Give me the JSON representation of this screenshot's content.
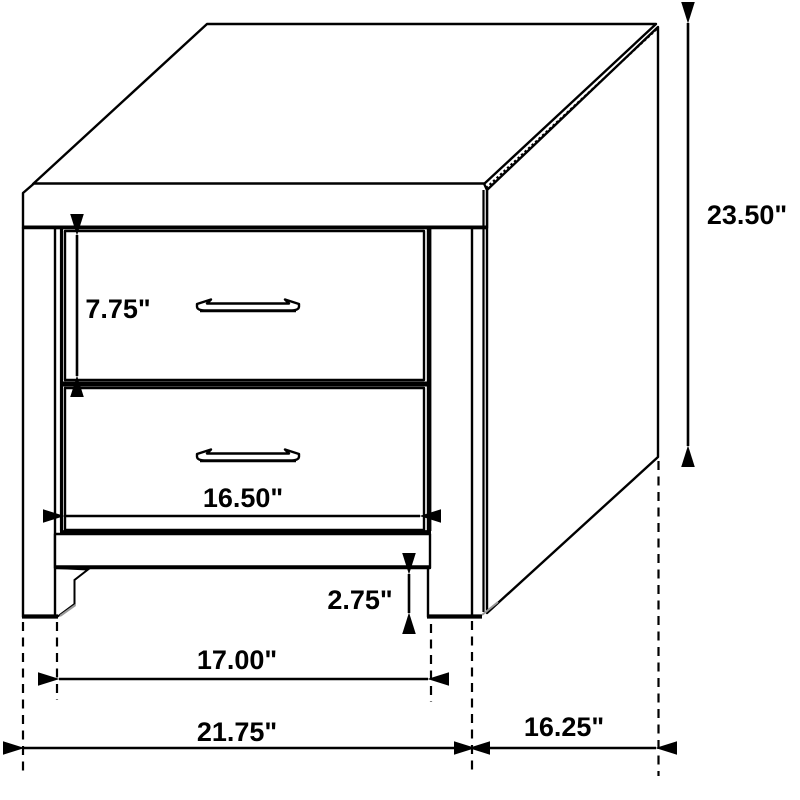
{
  "diagram": {
    "subject": "two-drawer nightstand dimension drawing",
    "colors": {
      "line": "#000000",
      "background": "#ffffff",
      "shade": "#9a9a9a"
    },
    "labels": {
      "drawer_height": "7.75\"",
      "overall_height": "23.50\"",
      "drawer_width": "16.50\"",
      "toe_kick_height": "2.75\"",
      "leg_span_width": "17.00\"",
      "overall_width": "21.75\"",
      "side_depth": "16.25\""
    }
  }
}
